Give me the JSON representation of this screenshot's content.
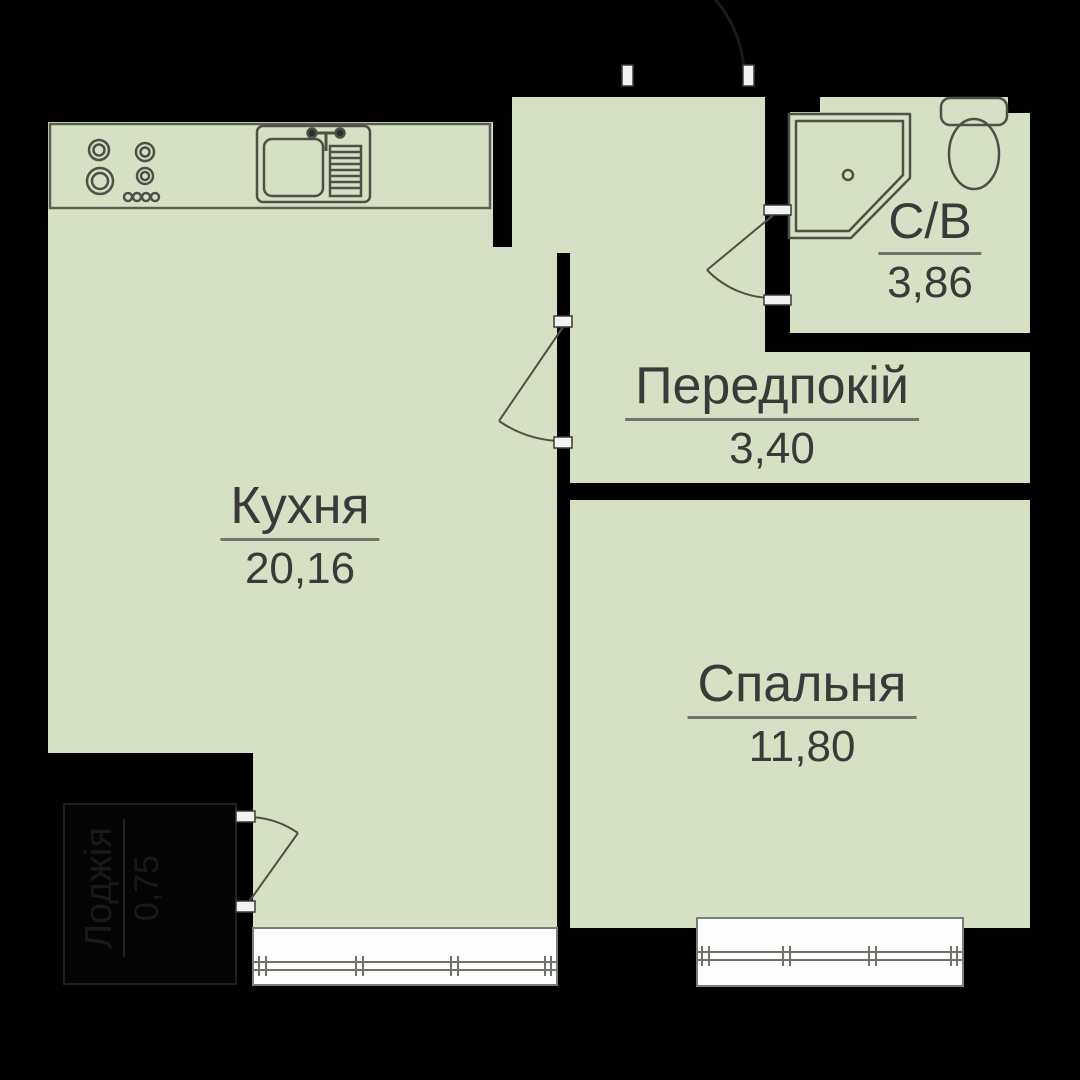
{
  "plan": {
    "type": "apartment-floor-plan",
    "colors": {
      "background": "#000000",
      "room_fill": "#d6e0c5",
      "wall": "#000000",
      "fixture_line": "#4d5248",
      "label_color": "#3a3a3a",
      "underline_color": "#70756a",
      "window_fill": "#fdfdfd",
      "window_line": "#6f746a",
      "jamb_fill": "#f2f2f2",
      "loggia_text": "#191919"
    },
    "rooms": {
      "kitchen": {
        "name": "Кухня",
        "area": "20,16"
      },
      "hallway": {
        "name": "Передпокій",
        "area": "3,40"
      },
      "bedroom": {
        "name": "Спальня",
        "area": "11,80"
      },
      "bathroom": {
        "name": "С/В",
        "area": "3,86"
      },
      "loggia": {
        "name": "Лоджія",
        "area": "0,75"
      }
    },
    "fixtures": [
      "stove-icon",
      "sink-icon",
      "shower-icon",
      "toilet-icon",
      "kitchen-counter",
      "window-kitchen",
      "window-bedroom",
      "door-kitchen-hallway",
      "door-bathroom",
      "door-loggia",
      "door-entrance"
    ]
  }
}
